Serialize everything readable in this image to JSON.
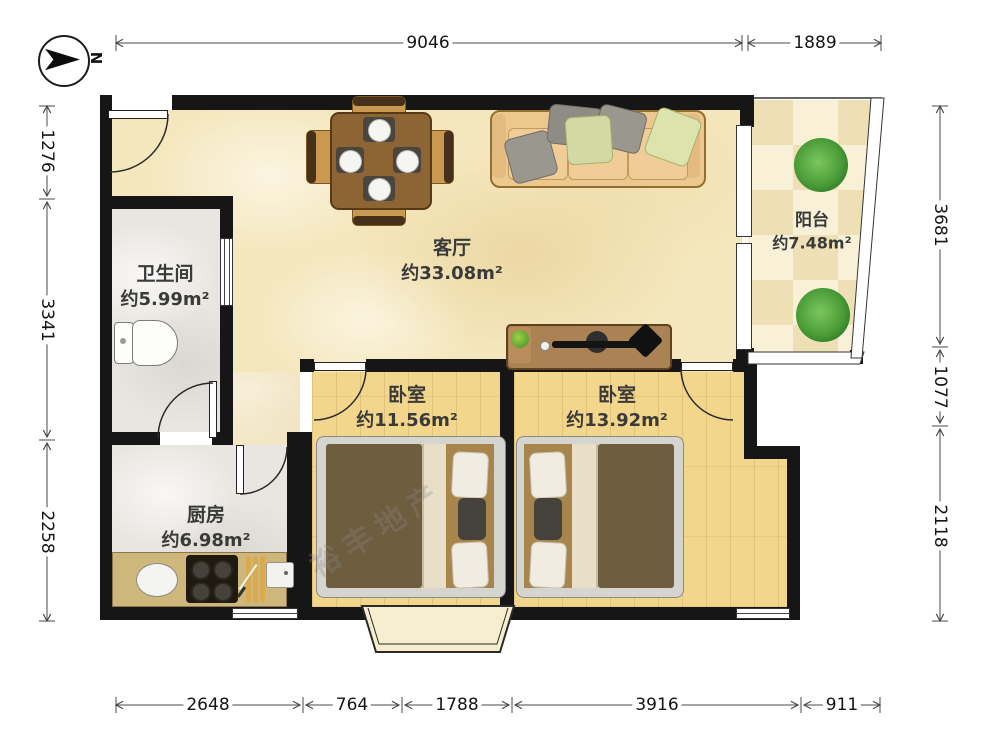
{
  "title": "两室一厅户型图",
  "compass": {
    "label": "N"
  },
  "watermark": "裕丰地产",
  "rooms": {
    "living": {
      "name": "客厅",
      "area": "约33.08m²"
    },
    "balcony": {
      "name": "阳台",
      "area": "约7.48m²"
    },
    "bathroom": {
      "name": "卫生间",
      "area": "约5.99m²"
    },
    "kitchen": {
      "name": "厨房",
      "area": "约6.98m²"
    },
    "bedroom_left": {
      "name": "卧室",
      "area": "约11.56m²"
    },
    "bedroom_right": {
      "name": "卧室",
      "area": "约13.92m²"
    }
  },
  "dimensions_mm": {
    "top": [
      "9046",
      "1889"
    ],
    "left": [
      "1276",
      "3341",
      "2258"
    ],
    "right": [
      "3681",
      "1077",
      "2118"
    ],
    "bottom": [
      "2648",
      "764",
      "1788",
      "3916",
      "911"
    ]
  },
  "colors": {
    "wall": "#161616",
    "living_floor": "#f5e7bd",
    "wood_floor": "#f2d68c",
    "tile_floor": "#f3ead0",
    "gray_floor": "#e9e6e1",
    "plant": "#3f8f2e",
    "sofa": "#ecc78e",
    "table": "#8d6434"
  }
}
